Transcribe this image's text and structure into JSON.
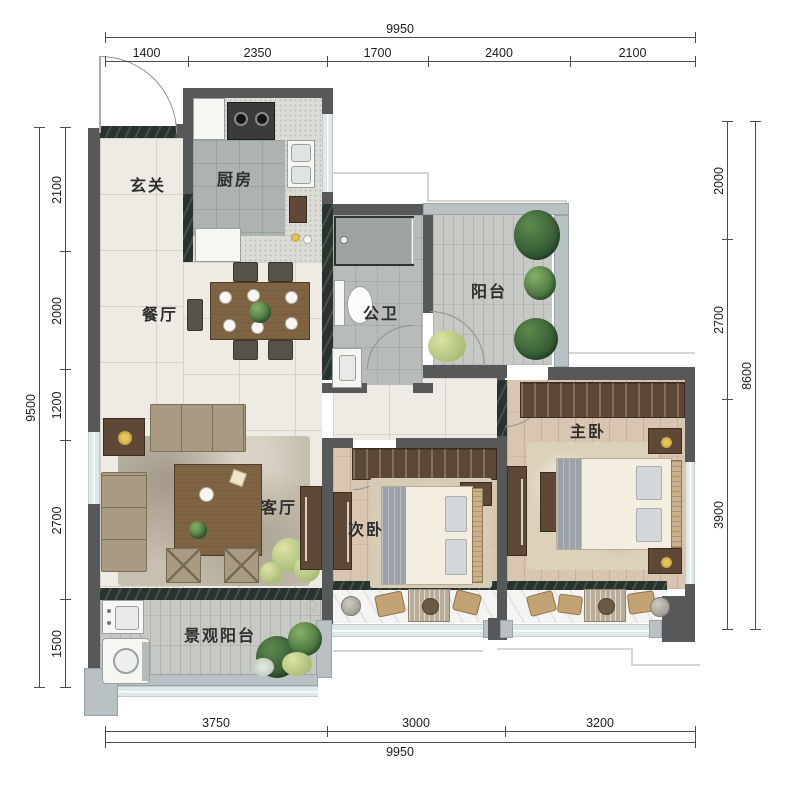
{
  "plan": {
    "rooms": {
      "entry": {
        "label": "玄关"
      },
      "kitchen": {
        "label": "厨房"
      },
      "dining": {
        "label": "餐厅"
      },
      "bath": {
        "label": "公卫"
      },
      "balcony": {
        "label": "阳台"
      },
      "living": {
        "label": "客厅"
      },
      "bedroom2": {
        "label": "次卧"
      },
      "master": {
        "label": "主卧"
      },
      "view_balcony": {
        "label": "景观阳台"
      }
    }
  },
  "dimensions": {
    "top": {
      "total": "9950",
      "segments": [
        "1400",
        "2350",
        "1700",
        "2400",
        "2100"
      ]
    },
    "bottom": {
      "total": "9950",
      "segments": [
        "3750",
        "3000",
        "3200"
      ]
    },
    "left": {
      "total": "9500",
      "segments": [
        "2100",
        "2000",
        "1200",
        "2700",
        "1500"
      ]
    },
    "right": {
      "total": "8600",
      "segments": [
        "2000",
        "2700",
        "3900"
      ]
    }
  },
  "colors": {
    "wall": "#57585a",
    "marble_sill": "#27332c",
    "outer_wall": "#b9c1c4",
    "window_glass": "#dde8ea",
    "cream_tile": "#edebe4",
    "wood_floor": "#d9c6b1",
    "gold_accent": "#c9a33a"
  }
}
